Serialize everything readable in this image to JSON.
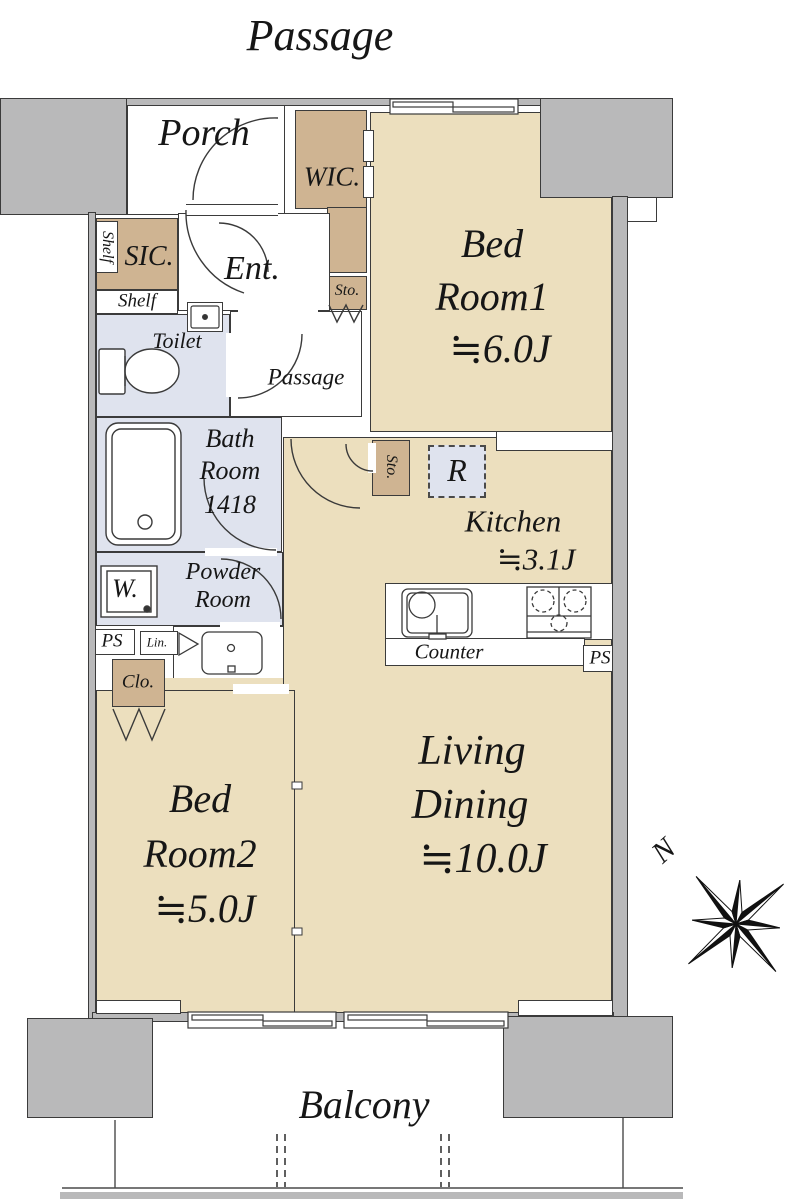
{
  "colors": {
    "wall": "#b9b9ba",
    "outline": "#3b3b3b",
    "room": "#ecdfbe",
    "closet": "#cfb492",
    "wet": "#dfe3ee",
    "dash": "#606060"
  },
  "labels": {
    "corridor": "Passage",
    "porch": "Porch",
    "wic": "WIC.",
    "bedroom1": {
      "line1": "Bed",
      "line2": "Room1",
      "area": "≒6.0J"
    },
    "shelf_vertical": "Shelf",
    "sic": "SIC.",
    "shelf": "Shelf",
    "entrance": "Ent.",
    "storage_entrance": "Sto.",
    "toilet": "Toilet",
    "passage_inner": "Passage",
    "bathroom": {
      "line1": "Bath",
      "line2": "Room",
      "size": "1418"
    },
    "storage_kitchen": "Sto.",
    "refrigerator": "R",
    "kitchen": {
      "line1": "Kitchen",
      "area": "≒3.1J"
    },
    "powder_room": {
      "line1": "Powder",
      "line2": "Room"
    },
    "washer": "W.",
    "ps_left": "PS",
    "linen": "Lin.",
    "counter": "Counter",
    "ps_right": "PS",
    "closet": "Clo.",
    "bedroom2": {
      "line1": "Bed",
      "line2": "Room2",
      "area": "≒5.0J"
    },
    "living_dining": {
      "line1": "Living",
      "line2": "Dining",
      "area": "≒10.0J"
    },
    "balcony": "Balcony",
    "compass_north": "N"
  }
}
